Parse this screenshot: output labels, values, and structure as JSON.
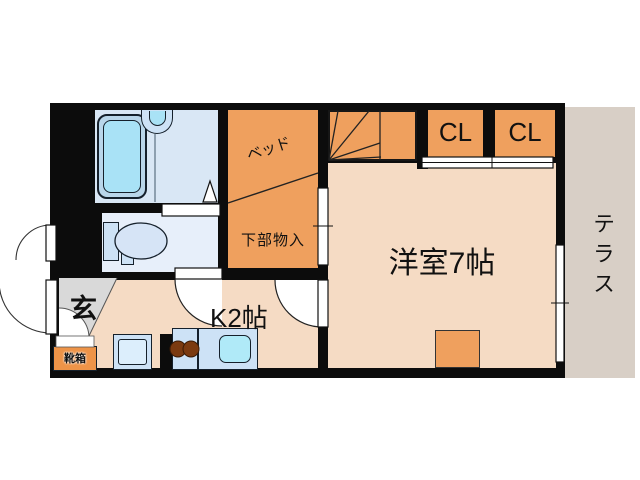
{
  "floorplan": {
    "rooms": {
      "bed": {
        "label": "ベッド"
      },
      "under_bed_storage": {
        "label": "下部物入"
      },
      "western_room": {
        "label": "洋室7帖"
      },
      "kitchen": {
        "label": "K2帖"
      },
      "closet_left": {
        "label": "CL"
      },
      "closet_right": {
        "label": "CL"
      },
      "terrace": {
        "label": "テラス"
      },
      "entrance": {
        "label": "玄"
      },
      "shoe_box": {
        "label": "靴箱"
      }
    },
    "colors": {
      "wall": "#0c0c0c",
      "orange": "#efa05e",
      "orange_deep": "#ee9448",
      "peach": "#f5dbc4",
      "terrace": "#d8cfc6",
      "genkan": "#d9d9d9",
      "bath_floor": "#d9e7f5",
      "toilet_floor": "#e7effa",
      "tub_rim": "#b9d6ea",
      "tub_inner": "#a9e2f6",
      "fixture": "#cde2f6",
      "sink": "#b0eaf8",
      "burner": "#7b3a10"
    }
  }
}
